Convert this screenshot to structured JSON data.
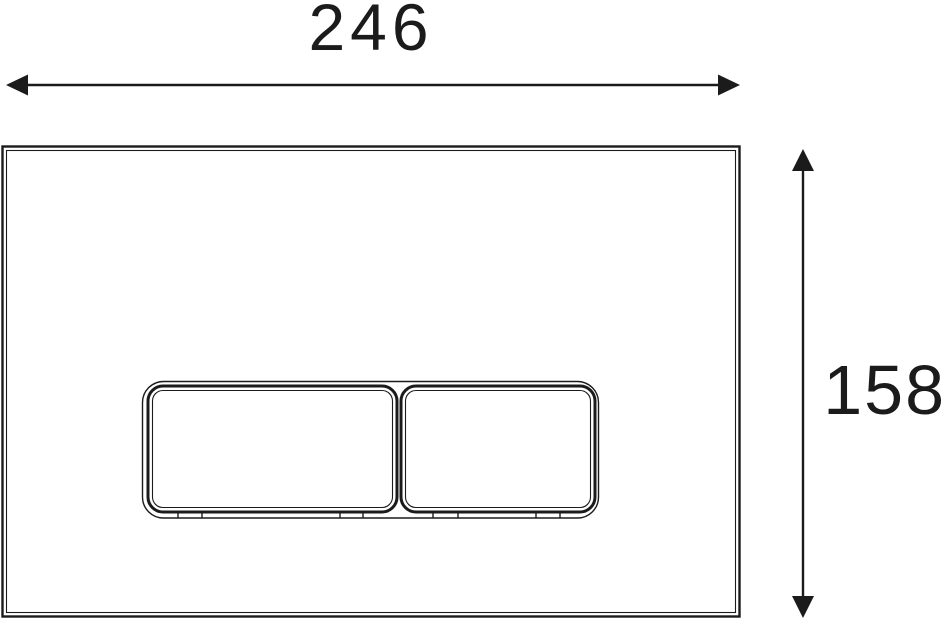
{
  "drawing": {
    "subject": "dual-flush-plate-front-view",
    "dimensions": {
      "width": {
        "value": "246",
        "orientation": "horizontal"
      },
      "height": {
        "value": "158",
        "orientation": "vertical"
      }
    },
    "parts": {
      "plate": "plate-outline",
      "large_button": "flush-button-large",
      "small_button": "flush-button-small"
    },
    "colors": {
      "line": "#1b1b1b",
      "background": "#ffffff"
    }
  }
}
